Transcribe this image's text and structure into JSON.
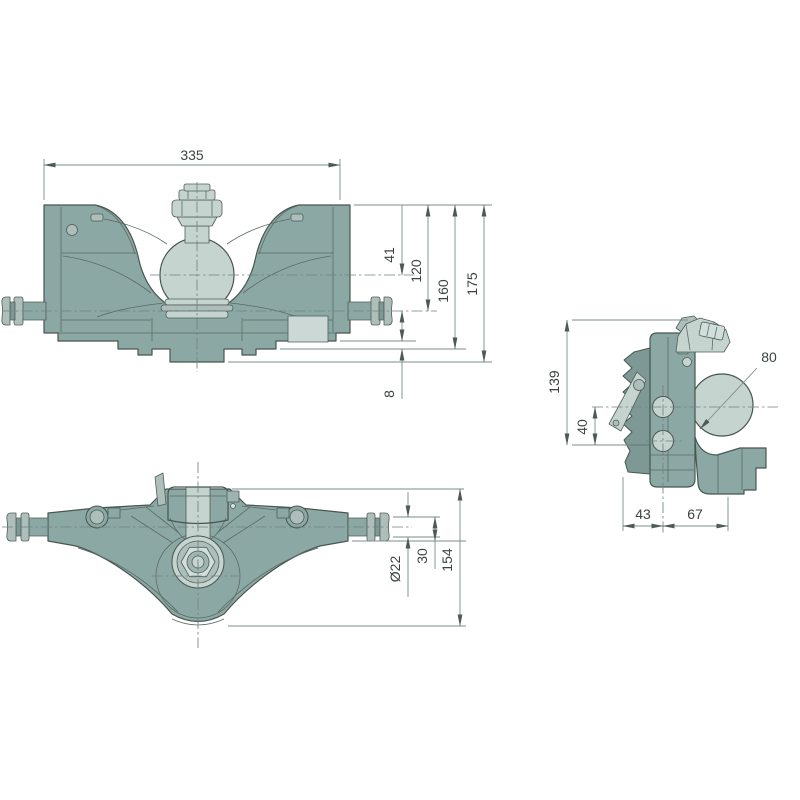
{
  "drawing": {
    "title": "hitch-coupling-technical-drawing",
    "background": "#ffffff",
    "colors": {
      "body": "#8CA8A4",
      "body_dark": "#7E9995",
      "light_part": "#C6D4D0",
      "mid_part": "#AEBFBB",
      "name_plate": "#CCD8D5",
      "outline": "#47564F",
      "inner_line": "#5A6B65",
      "dim_line": "#7A8F8B",
      "center_line": "#6F8480",
      "text": "#3B4340"
    },
    "views": {
      "front": {
        "label": "front-view",
        "dims": {
          "overall_width": "335",
          "ball_axis_offset": "41",
          "pin_axis_from_top": "120",
          "lower_face_from_top": "160",
          "overall_height": "175",
          "flange_step": "8"
        }
      },
      "top": {
        "label": "top-view",
        "dims": {
          "pin_diameter": "Ø22",
          "pin_axis_offset": "30",
          "overall_depth": "154"
        }
      },
      "side": {
        "label": "side-view",
        "dims": {
          "frame_height": "139",
          "hole_axis_to_base": "40",
          "ball_diameter": "80",
          "rear_to_hole_axis": "43",
          "hole_axis_to_front": "67"
        }
      }
    }
  }
}
